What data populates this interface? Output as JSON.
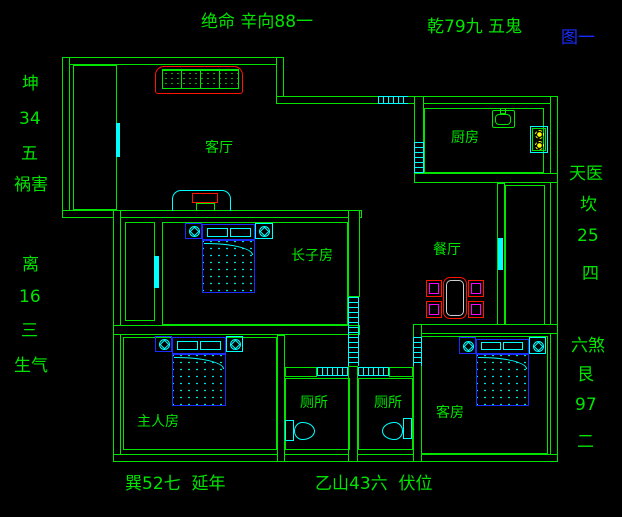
{
  "figure_label": "图一",
  "annotations": {
    "top_center": "绝命 辛向88一",
    "top_right": "乾79九 五鬼",
    "left_upper": [
      "坤",
      "34",
      "五",
      "祸害"
    ],
    "left_lower": [
      "离",
      "16",
      "三",
      "生气"
    ],
    "right_upper": [
      "天医",
      "坎",
      "25",
      "四"
    ],
    "right_lower": [
      "六煞",
      "艮",
      "97",
      "二"
    ],
    "bottom_left": "巽52七  延年",
    "bottom_center": "乙山43六  伏位"
  },
  "rooms": {
    "living": "客厅",
    "kitchen": "厨房",
    "dining": "餐厅",
    "eldest_son": "长子房",
    "master": "主人房",
    "toilet_1": "厕所",
    "toilet_2": "厕所",
    "guest": "客房"
  },
  "colors": {
    "background": "#000000",
    "wall_green": "#00e400",
    "window_cyan": "#00ffff",
    "furniture_blue": "#1b2cff",
    "accent_red": "#ff1400",
    "chair_magenta": "#ff00ff",
    "burner_yellow": "#ffff00",
    "figure_blue": "#1a2cff"
  }
}
